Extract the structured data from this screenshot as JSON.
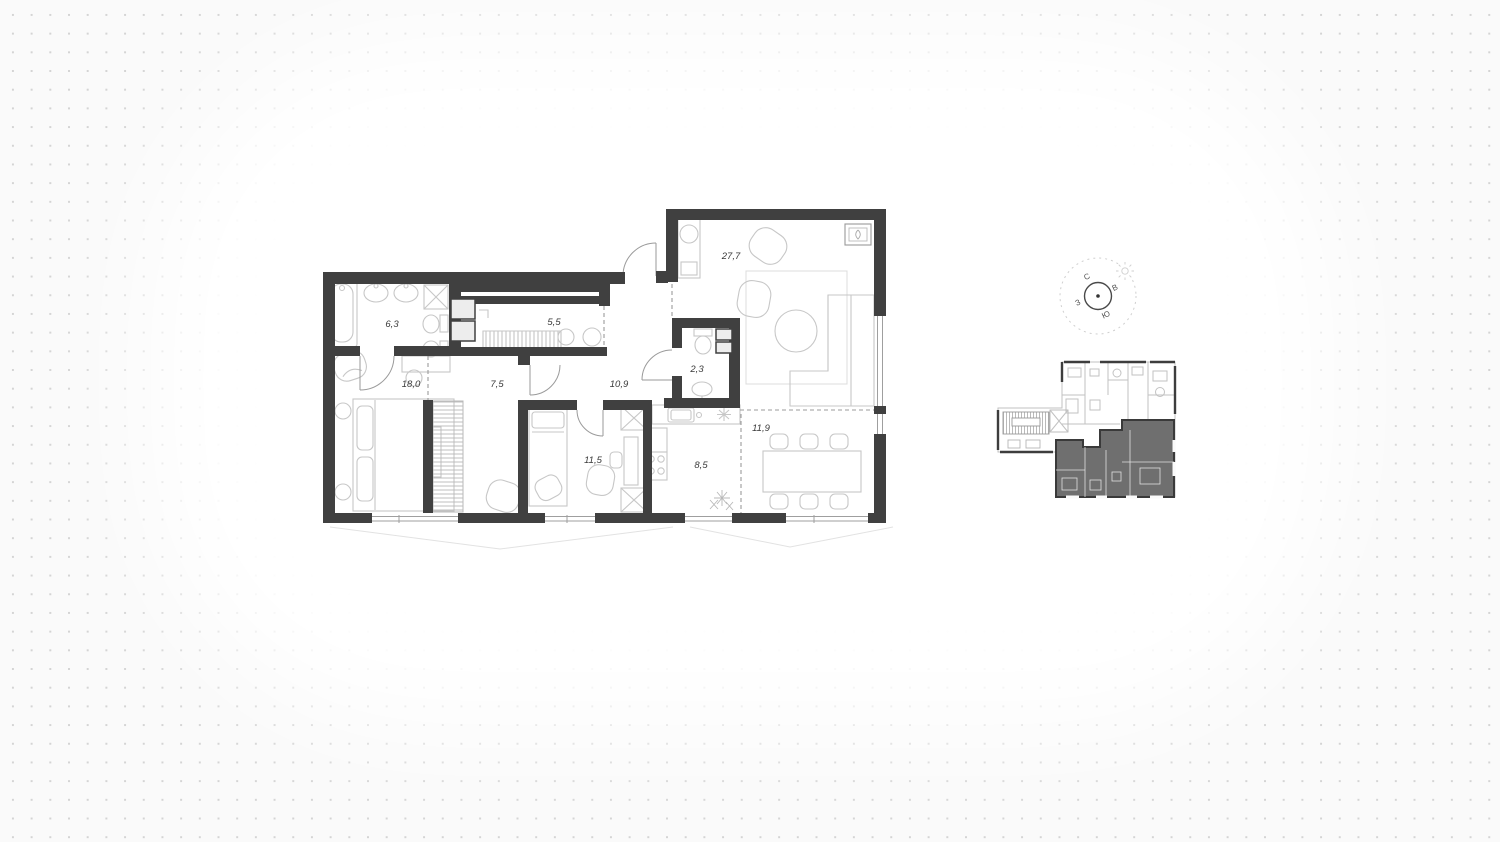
{
  "canvas": {
    "background": "#fafafa",
    "dot_color": "#d4d4d4",
    "card_color": "#ffffff"
  },
  "floor_plan": {
    "wall_color": "#404040",
    "furniture_color": "#c7c7c7",
    "rooms": [
      {
        "id": "bathroom",
        "area": "6,3"
      },
      {
        "id": "wardrobe",
        "area": "5,5"
      },
      {
        "id": "bedroom",
        "area": "18,0"
      },
      {
        "id": "hall",
        "area": "7,5"
      },
      {
        "id": "corridor",
        "area": "10,9"
      },
      {
        "id": "wc",
        "area": "2,3"
      },
      {
        "id": "living-room",
        "area": "27,7"
      },
      {
        "id": "bedroom-2",
        "area": "11,5"
      },
      {
        "id": "kitchen",
        "area": "8,5"
      },
      {
        "id": "dining",
        "area": "11,9"
      }
    ]
  },
  "compass": {
    "north": "С",
    "east": "В",
    "south": "Ю",
    "west": "З"
  },
  "mini_plan": {
    "highlight_color": "#6f6f6f"
  }
}
